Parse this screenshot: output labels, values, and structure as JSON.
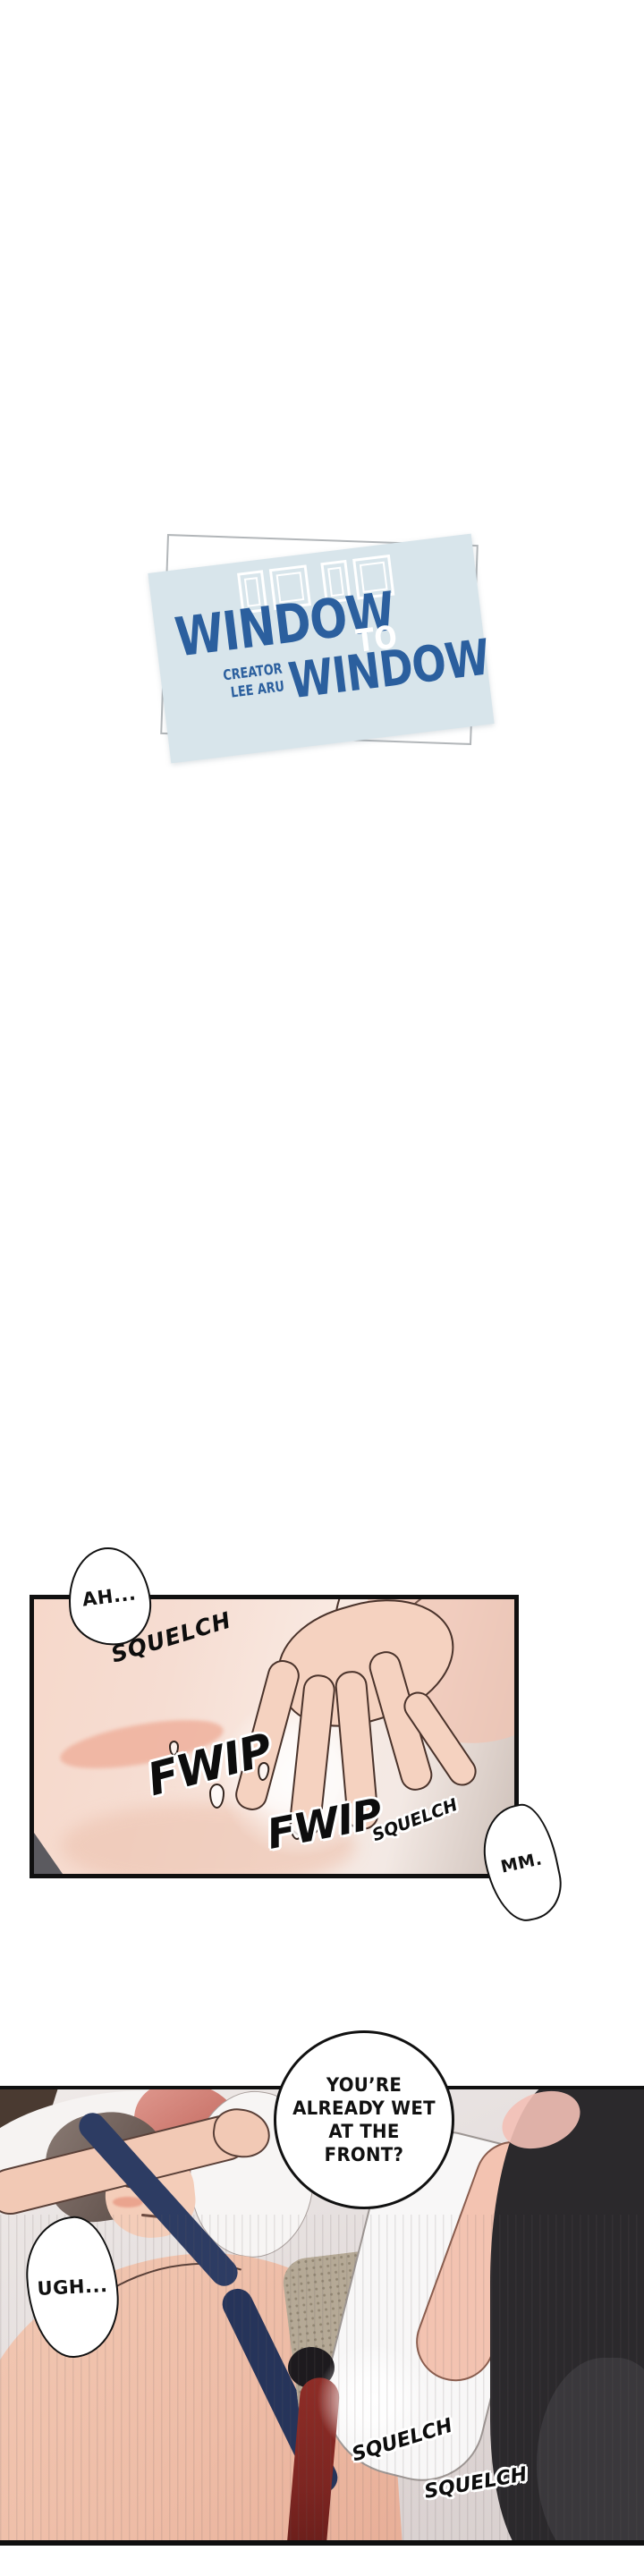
{
  "series": {
    "title_word_top": "WINDOW",
    "title_connector": "TO",
    "title_word_bottom": "WINDOW",
    "creator_label": "CREATOR",
    "creator_name": "LEE ARU"
  },
  "colors": {
    "card_background": "#d8e5eb",
    "title_blue": "#2b5f9e",
    "connector_white": "#ffffff",
    "backing_border_gray": "#b2b6b9",
    "panel_border_black": "#101010",
    "skin_tone": "#f5d8ca",
    "navy_tie": "#2d3c63",
    "dark_red_tie": "#7c2521",
    "wall_brown": "#4a3a31"
  },
  "panel1": {
    "bubble_ah": "AH...",
    "bubble_mm": "MM.",
    "sfx_squelch_1": "SQUELCH",
    "sfx_fwip_1": "FWIP",
    "sfx_fwip_2": "FWIP",
    "sfx_squelch_2": "SQUELCH"
  },
  "panel2": {
    "bubble_main_lines": [
      "YOU’RE",
      "ALREADY WET",
      "AT THE",
      "FRONT?"
    ],
    "bubble_ugh": "UGH...",
    "sfx_squelch_1": "SQUELCH",
    "sfx_squelch_2": "SQUELCH"
  }
}
